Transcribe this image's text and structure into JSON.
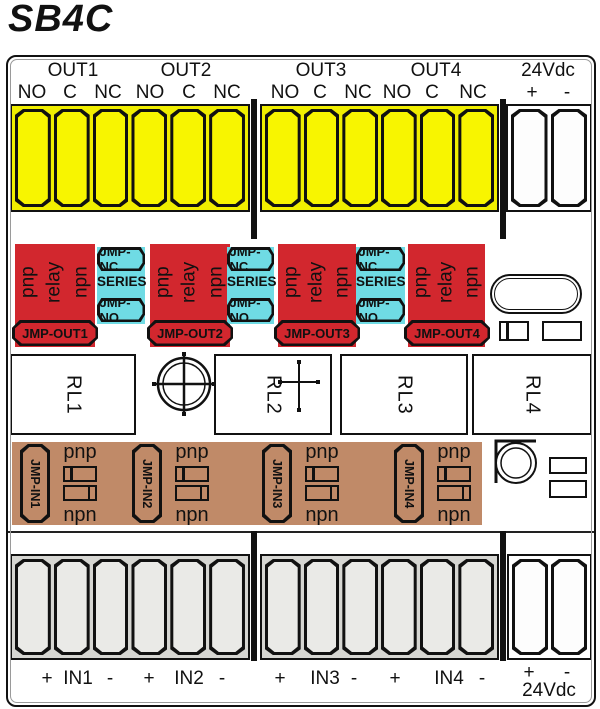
{
  "title": "SB4C",
  "colors": {
    "terminal_yellow": "#f8f500",
    "jumper_red": "#d2272e",
    "series_cyan": "#6fdbe4",
    "input_tan": "#c08a68",
    "terminal_gray": "#eaeae7",
    "outline": "#111111"
  },
  "top_header": {
    "out_groups": [
      {
        "label": "OUT1",
        "pins": [
          "NO",
          "C",
          "NC"
        ]
      },
      {
        "label": "OUT2",
        "pins": [
          "NO",
          "C",
          "NC"
        ]
      },
      {
        "label": "OUT3",
        "pins": [
          "NO",
          "C",
          "NC"
        ]
      },
      {
        "label": "OUT4",
        "pins": [
          "NO",
          "C",
          "NC"
        ]
      }
    ],
    "power": {
      "label": "24Vdc",
      "pins": [
        "+",
        "-"
      ]
    }
  },
  "jumper_out_row": {
    "relay_blocks": [
      {
        "vertical_labels": [
          "pnp",
          "relay",
          "npn"
        ],
        "jumper": "JMP-OUT1"
      },
      {
        "vertical_labels": [
          "pnp",
          "relay",
          "npn"
        ],
        "jumper": "JMP-OUT2"
      },
      {
        "vertical_labels": [
          "pnp",
          "relay",
          "npn"
        ],
        "jumper": "JMP-OUT3"
      },
      {
        "vertical_labels": [
          "pnp",
          "relay",
          "npn"
        ],
        "jumper": "JMP-OUT4"
      }
    ],
    "series_blocks": [
      {
        "top": "JMP-NC",
        "middle": "SERIES",
        "bottom": "JMP-NO"
      },
      {
        "top": "JMP-NC",
        "middle": "SERIES",
        "bottom": "JMP-NO"
      },
      {
        "top": "JMP-NC",
        "middle": "SERIES",
        "bottom": "JMP-NO"
      }
    ]
  },
  "relay_row": {
    "relays": [
      "RL1",
      "RL2",
      "RL3",
      "RL4"
    ]
  },
  "jumper_in_row": {
    "blocks": [
      {
        "jumper": "JMP-IN1",
        "top": "pnp",
        "bottom": "npn"
      },
      {
        "jumper": "JMP-IN2",
        "top": "pnp",
        "bottom": "npn"
      },
      {
        "jumper": "JMP-IN3",
        "top": "pnp",
        "bottom": "npn"
      },
      {
        "jumper": "JMP-IN4",
        "top": "pnp",
        "bottom": "npn"
      }
    ]
  },
  "bottom_labels": {
    "groups": [
      {
        "plus": "+",
        "label": "IN1",
        "minus": "-"
      },
      {
        "plus": "+",
        "label": "IN2",
        "minus": "-"
      },
      {
        "plus": "+",
        "label": "IN3",
        "minus": "-"
      },
      {
        "plus": "+",
        "label": "IN4",
        "minus": "-"
      }
    ],
    "power": {
      "plus": "+",
      "minus": "-",
      "label": "24Vdc"
    }
  }
}
